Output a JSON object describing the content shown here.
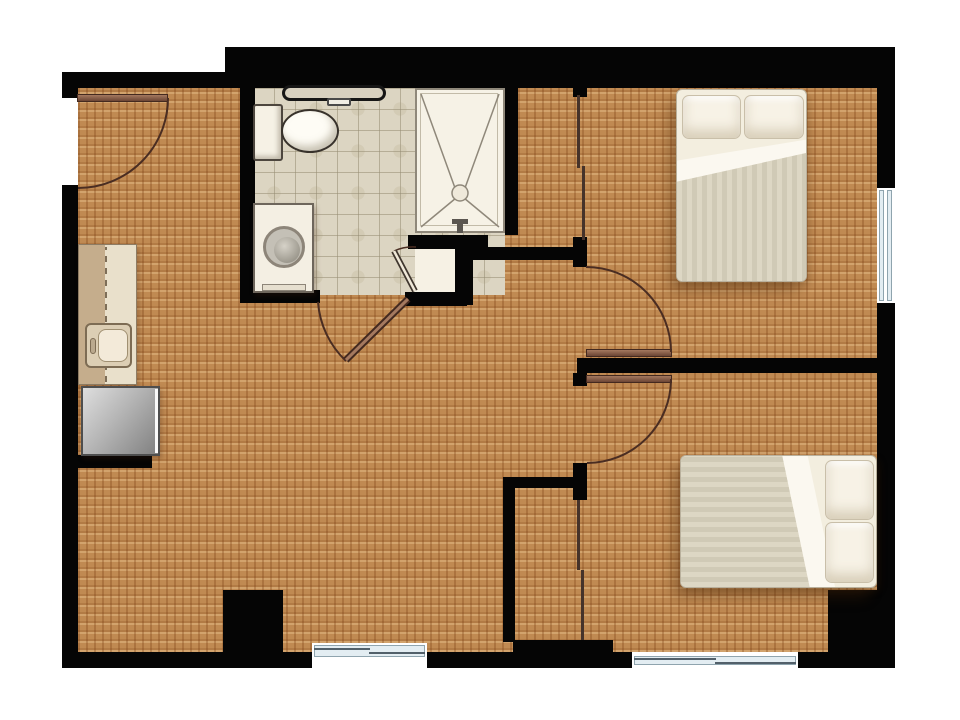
{
  "floor_plan": {
    "description": "Two-bedroom apartment floor plan, top-down architectural view, no text labels",
    "rooms": [
      {
        "name": "living-room-kitchen",
        "floor": "carpet",
        "features": [
          "kitchen-counter-with-sink",
          "refrigerator",
          "kitchen-half-wall",
          "structural-column"
        ]
      },
      {
        "name": "bathroom",
        "floor": "tile",
        "fixtures": [
          "vanity-shelf",
          "toilet",
          "washer",
          "shower-stall",
          "linen-closet"
        ]
      },
      {
        "name": "bedroom-1",
        "position": "top-right",
        "floor": "carpet",
        "furniture": [
          "double-bed-vertical"
        ],
        "closet": "sliding-door-closet"
      },
      {
        "name": "bedroom-2",
        "position": "bottom-right",
        "floor": "carpet",
        "furniture": [
          "double-bed-horizontal"
        ],
        "closet": "sliding-door-closet"
      }
    ],
    "doors": [
      {
        "name": "entry-door",
        "wall": "left-exterior",
        "swing": "into-living-room"
      },
      {
        "name": "bathroom-door",
        "wall": "bathroom-south",
        "swing": "into-living-room"
      },
      {
        "name": "linen-closet-door",
        "swing": "into-bathroom"
      },
      {
        "name": "bedroom-1-door",
        "swing": "into-bedroom-1"
      },
      {
        "name": "bedroom-2-door",
        "swing": "into-bedroom-2"
      }
    ],
    "windows": [
      {
        "name": "bedroom-1-window",
        "wall": "right-exterior"
      },
      {
        "name": "bedroom-2-window",
        "wall": "bottom-exterior"
      },
      {
        "name": "living-room-window",
        "wall": "bottom-exterior"
      }
    ],
    "palette": {
      "wall": "#050505",
      "carpet": "#c08a52",
      "tile": "#dcd5c2",
      "window_glass": "#e3edf2",
      "door_leaf": "#8a5e4e",
      "door_arc": "#4a2d22",
      "linen_floor": "#f6f1e4",
      "appliance_gray": "#9a9a9a",
      "bedding_white": "#f3eedf",
      "blanket": "#d6d0bc"
    }
  }
}
